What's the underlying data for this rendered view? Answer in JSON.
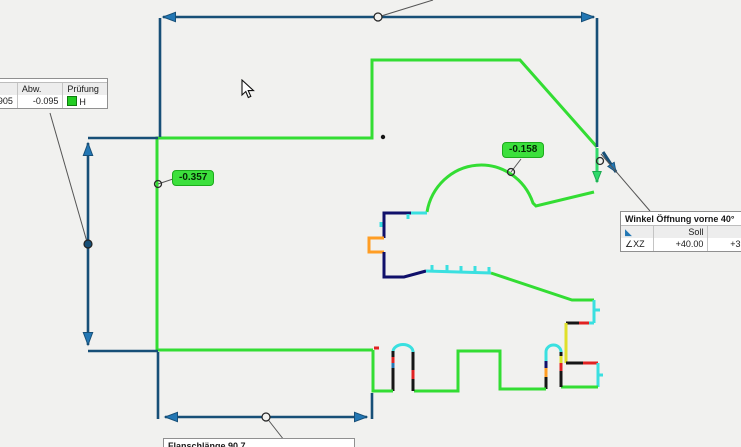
{
  "colors": {
    "canvas-bg": "#f1f1ef",
    "dim-line": "#174f77",
    "dim-arrow": "#2377b4",
    "contour-green": "#33dd33",
    "contour-cyan": "#3ae0e0",
    "contour-navy": "#10106a",
    "contour-orange": "#ff9d23",
    "contour-yellow": "#e0e02a",
    "contour-red": "#e02222",
    "accent-teal": "#2fd96a",
    "flag-bg": "#3ce03c",
    "flag-border": "#1daa1d",
    "callout-line": "#555555",
    "tooltip-bg": "#ffffff",
    "tooltip-border": "#909090",
    "icon-green": "#22cc22"
  },
  "left_table": {
    "title": "",
    "headers": [
      "",
      "Abw.",
      "Prüfung"
    ],
    "values": [
      "+0.905",
      "-0.095"
    ],
    "check_label": "H",
    "check_icon": "green-square-icon"
  },
  "flags": [
    {
      "text": "-0.357"
    },
    {
      "text": "-0.158"
    }
  ],
  "angle_tooltip": {
    "title": "Winkel Öffnung vorne 40°",
    "corner_icon": "◣",
    "headers": [
      "Soll",
      "Ist"
    ],
    "row_label": "∠XZ",
    "soll": "+40.00",
    "ist": "+39.97"
  },
  "bottom_tooltip": {
    "title": "Flanschlänge 90.7"
  }
}
